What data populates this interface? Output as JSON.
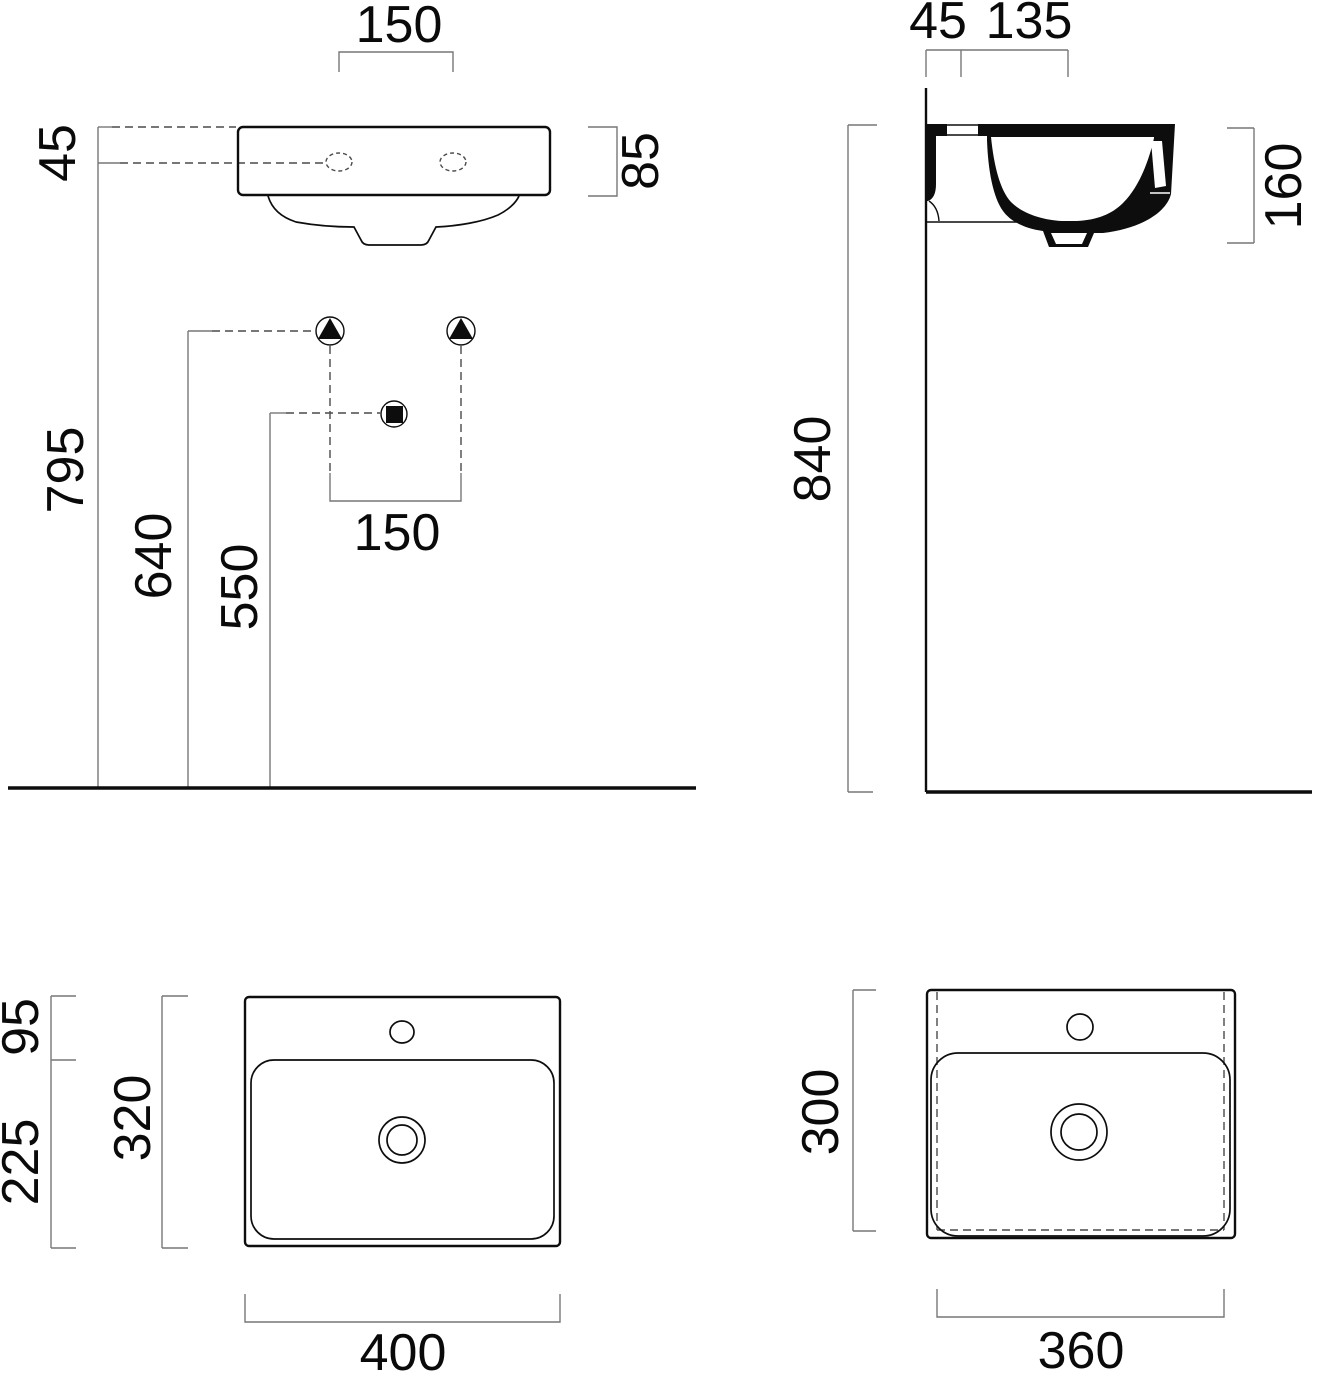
{
  "drawing": {
    "kind": "washbasin installation dimension drawing",
    "units": "mm",
    "ink_color": "#0d0d0d",
    "dim_line_color": "#777777",
    "views": {
      "front": {
        "name": "front elevation"
      },
      "side": {
        "name": "side section"
      },
      "plan_top": {
        "name": "plan view from above"
      },
      "plan_bottom": {
        "name": "plan view from below"
      }
    }
  },
  "dims": {
    "front": {
      "tap_hole_spacing_top": "150",
      "rim_to_tap_offset": "45",
      "rim_height": "85",
      "floor_to_tap_line": "795",
      "floor_to_supply": "640",
      "floor_to_drain": "550",
      "supply_spacing": "150"
    },
    "side": {
      "wall_to_tap": "45",
      "tap_to_front": "135",
      "basin_depth": "160",
      "floor_to_rim": "840"
    },
    "plan_top": {
      "deck_depth": "95",
      "bowl_depth": "225",
      "total_depth": "320",
      "total_width": "400"
    },
    "plan_bottom": {
      "total_depth": "300",
      "total_width": "360"
    }
  }
}
